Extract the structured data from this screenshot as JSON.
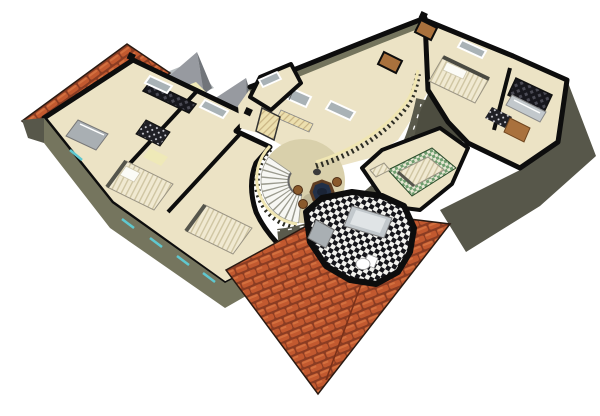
{
  "meta": {
    "title": "3D cutaway floor plan rendering",
    "view": "isometric aerial",
    "floor": "upper floor with roof sections"
  },
  "palette": {
    "bg": "#ffffff",
    "ink": "#0d0d0d",
    "cream": "#ece3c5",
    "tan": "#d9d0ab",
    "olive": "#74745d",
    "oliveDark": "#565647",
    "facade": "#75755e",
    "facadeDark": "#57574a",
    "slab": "#4d4d40",
    "walkway": "#5a5a4c",
    "tile": "#c2592f",
    "tileHi": "#d3703f",
    "tileGap": "#8a3c22",
    "railCream": "#f0e6b2",
    "baluster": "#2d2d23",
    "stairWhite": "#f7f7f3",
    "stairEdge": "#9a9a8e",
    "glass": "#a9b2b6",
    "frameWhite": "#ffffff",
    "cyan": "#5fc8d0",
    "wood": "#a9713d",
    "woodEdge": "#6f451f",
    "metal": "#a9afb3",
    "tub": "#c2c8cc",
    "tubInner": "#e0e4e6",
    "green": "#6f9e6f",
    "greenBg": "#e7e7d3",
    "bedBase": "#f0e9d1",
    "bedStripe": "#cfc5a2",
    "headboard": "#55554c",
    "tableTop": "#223048",
    "tableWood": "#5f3d22",
    "stool": "#8a5a2c",
    "stoolEdge": "#4f2f16",
    "gable": "#979aa0",
    "gableDark": "#71757a",
    "slabRoof": "#b7bdbf",
    "paleYellow": "#efe9b8",
    "checkA": "#f2f2ee",
    "checkB": "#15151a",
    "gridBg": "#17171d",
    "gridDot": "#4a4a54",
    "dotBg": "#202026",
    "dotFg": "#d6d6de",
    "hatchBg": "#ecdfae",
    "hatchLn": "#c9b483"
  },
  "scene": {
    "roofs": [
      {
        "id": "roof-top-left",
        "material": "clay-tiles"
      },
      {
        "id": "roof-main",
        "material": "clay-tiles"
      }
    ],
    "rooms": [
      {
        "id": "wardrobe-room",
        "furniture": [
          "wardrobe-shelving",
          "dresser",
          "pantry-rack"
        ]
      },
      {
        "id": "bedroom-1",
        "furniture": [
          "double-bed"
        ]
      },
      {
        "id": "bedroom-2",
        "furniture": [
          "double-bed"
        ]
      },
      {
        "id": "upper-hallway",
        "furniture": [
          "radiator",
          "windows"
        ]
      },
      {
        "id": "stair-landing",
        "furniture": [
          "spiral-staircase",
          "dining-table",
          "stools",
          "balustrade"
        ]
      },
      {
        "id": "bedroom-3",
        "furniture": [
          "double-bed",
          "closet-shelving",
          "bathtub"
        ]
      },
      {
        "id": "green-room",
        "furniture": [
          "green-check-rug",
          "daybed",
          "bench"
        ]
      },
      {
        "id": "bathroom",
        "furniture": [
          "bathtub",
          "toilet",
          "sink-cabinet",
          "checker-floor"
        ]
      }
    ],
    "stair": {
      "cx": 303,
      "cy": 181,
      "rInner": 15,
      "rOuter": 42,
      "startDeg": 215,
      "endDeg": 95,
      "steps": 12
    }
  }
}
